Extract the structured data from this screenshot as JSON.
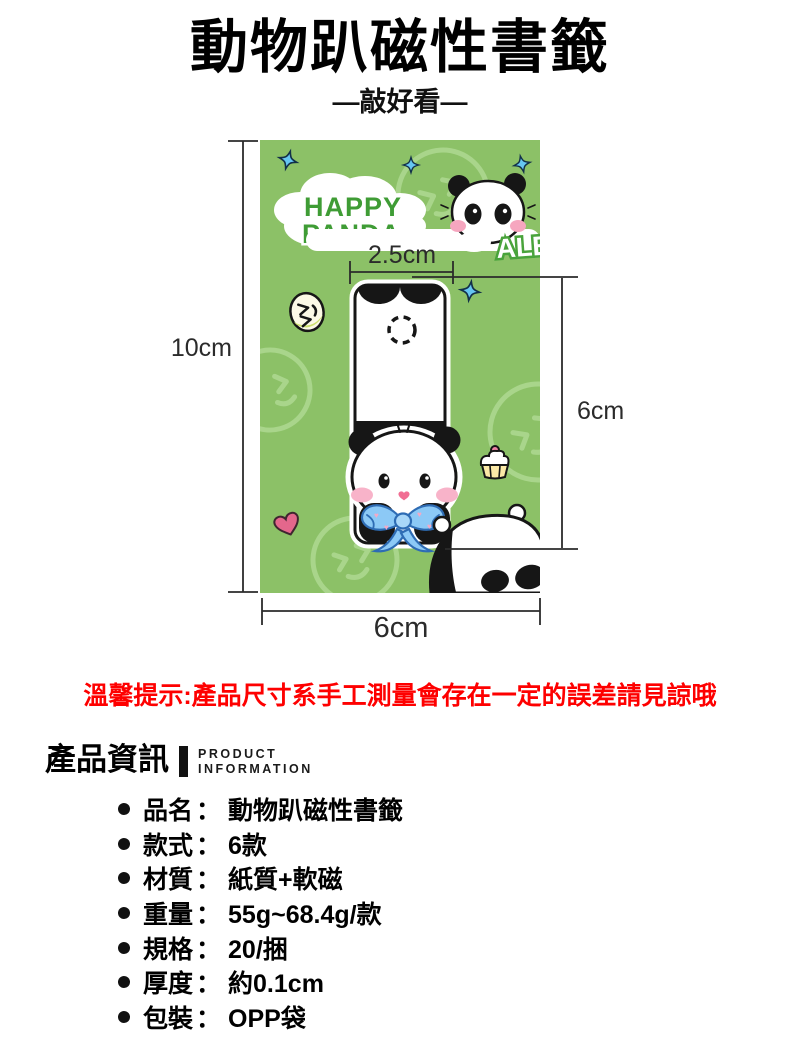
{
  "header": {
    "title": "動物趴磁性書籤",
    "subtitle": "—敲好看—"
  },
  "card": {
    "happy_line1": "HAPPY",
    "happy_line2": "PANDA",
    "corner_text": "ALE"
  },
  "dimensions": {
    "card_height": "10cm",
    "bookmark_width": "2.5cm",
    "bookmark_height": "6cm",
    "card_width": "6cm"
  },
  "notice": "溫馨提示:產品尺寸系手工測量會存在一定的誤差請見諒哦",
  "product_info": {
    "heading": "產品資訊",
    "subheading_line1": "PRODUCT",
    "subheading_line2": "INFORMATION",
    "colon": "：",
    "items": [
      {
        "label": "品名",
        "value": "動物趴磁性書籤"
      },
      {
        "label": "款式",
        "value": "6款"
      },
      {
        "label": "材質",
        "value": "紙質+軟磁"
      },
      {
        "label": "重量",
        "value": "55g~68.4g/款"
      },
      {
        "label": "規格",
        "value": "20/捆"
      },
      {
        "label": "厚度",
        "value": "約0.1cm"
      },
      {
        "label": "包裝",
        "value": "OPP袋"
      }
    ]
  },
  "colors": {
    "card_green": "#8cc167",
    "pattern_green": "#a9d58b",
    "bubble_text_green": "#3f9c35",
    "notice_red": "#fe0000",
    "star_blue": "#66c6f2",
    "bow_blue": "#8cc9f6",
    "bow_outline_blue": "#2e6cb4",
    "cheek_pink": "#f8b3c9",
    "heart_pink": "#e4678c",
    "line_black": "#2b2b2b"
  }
}
